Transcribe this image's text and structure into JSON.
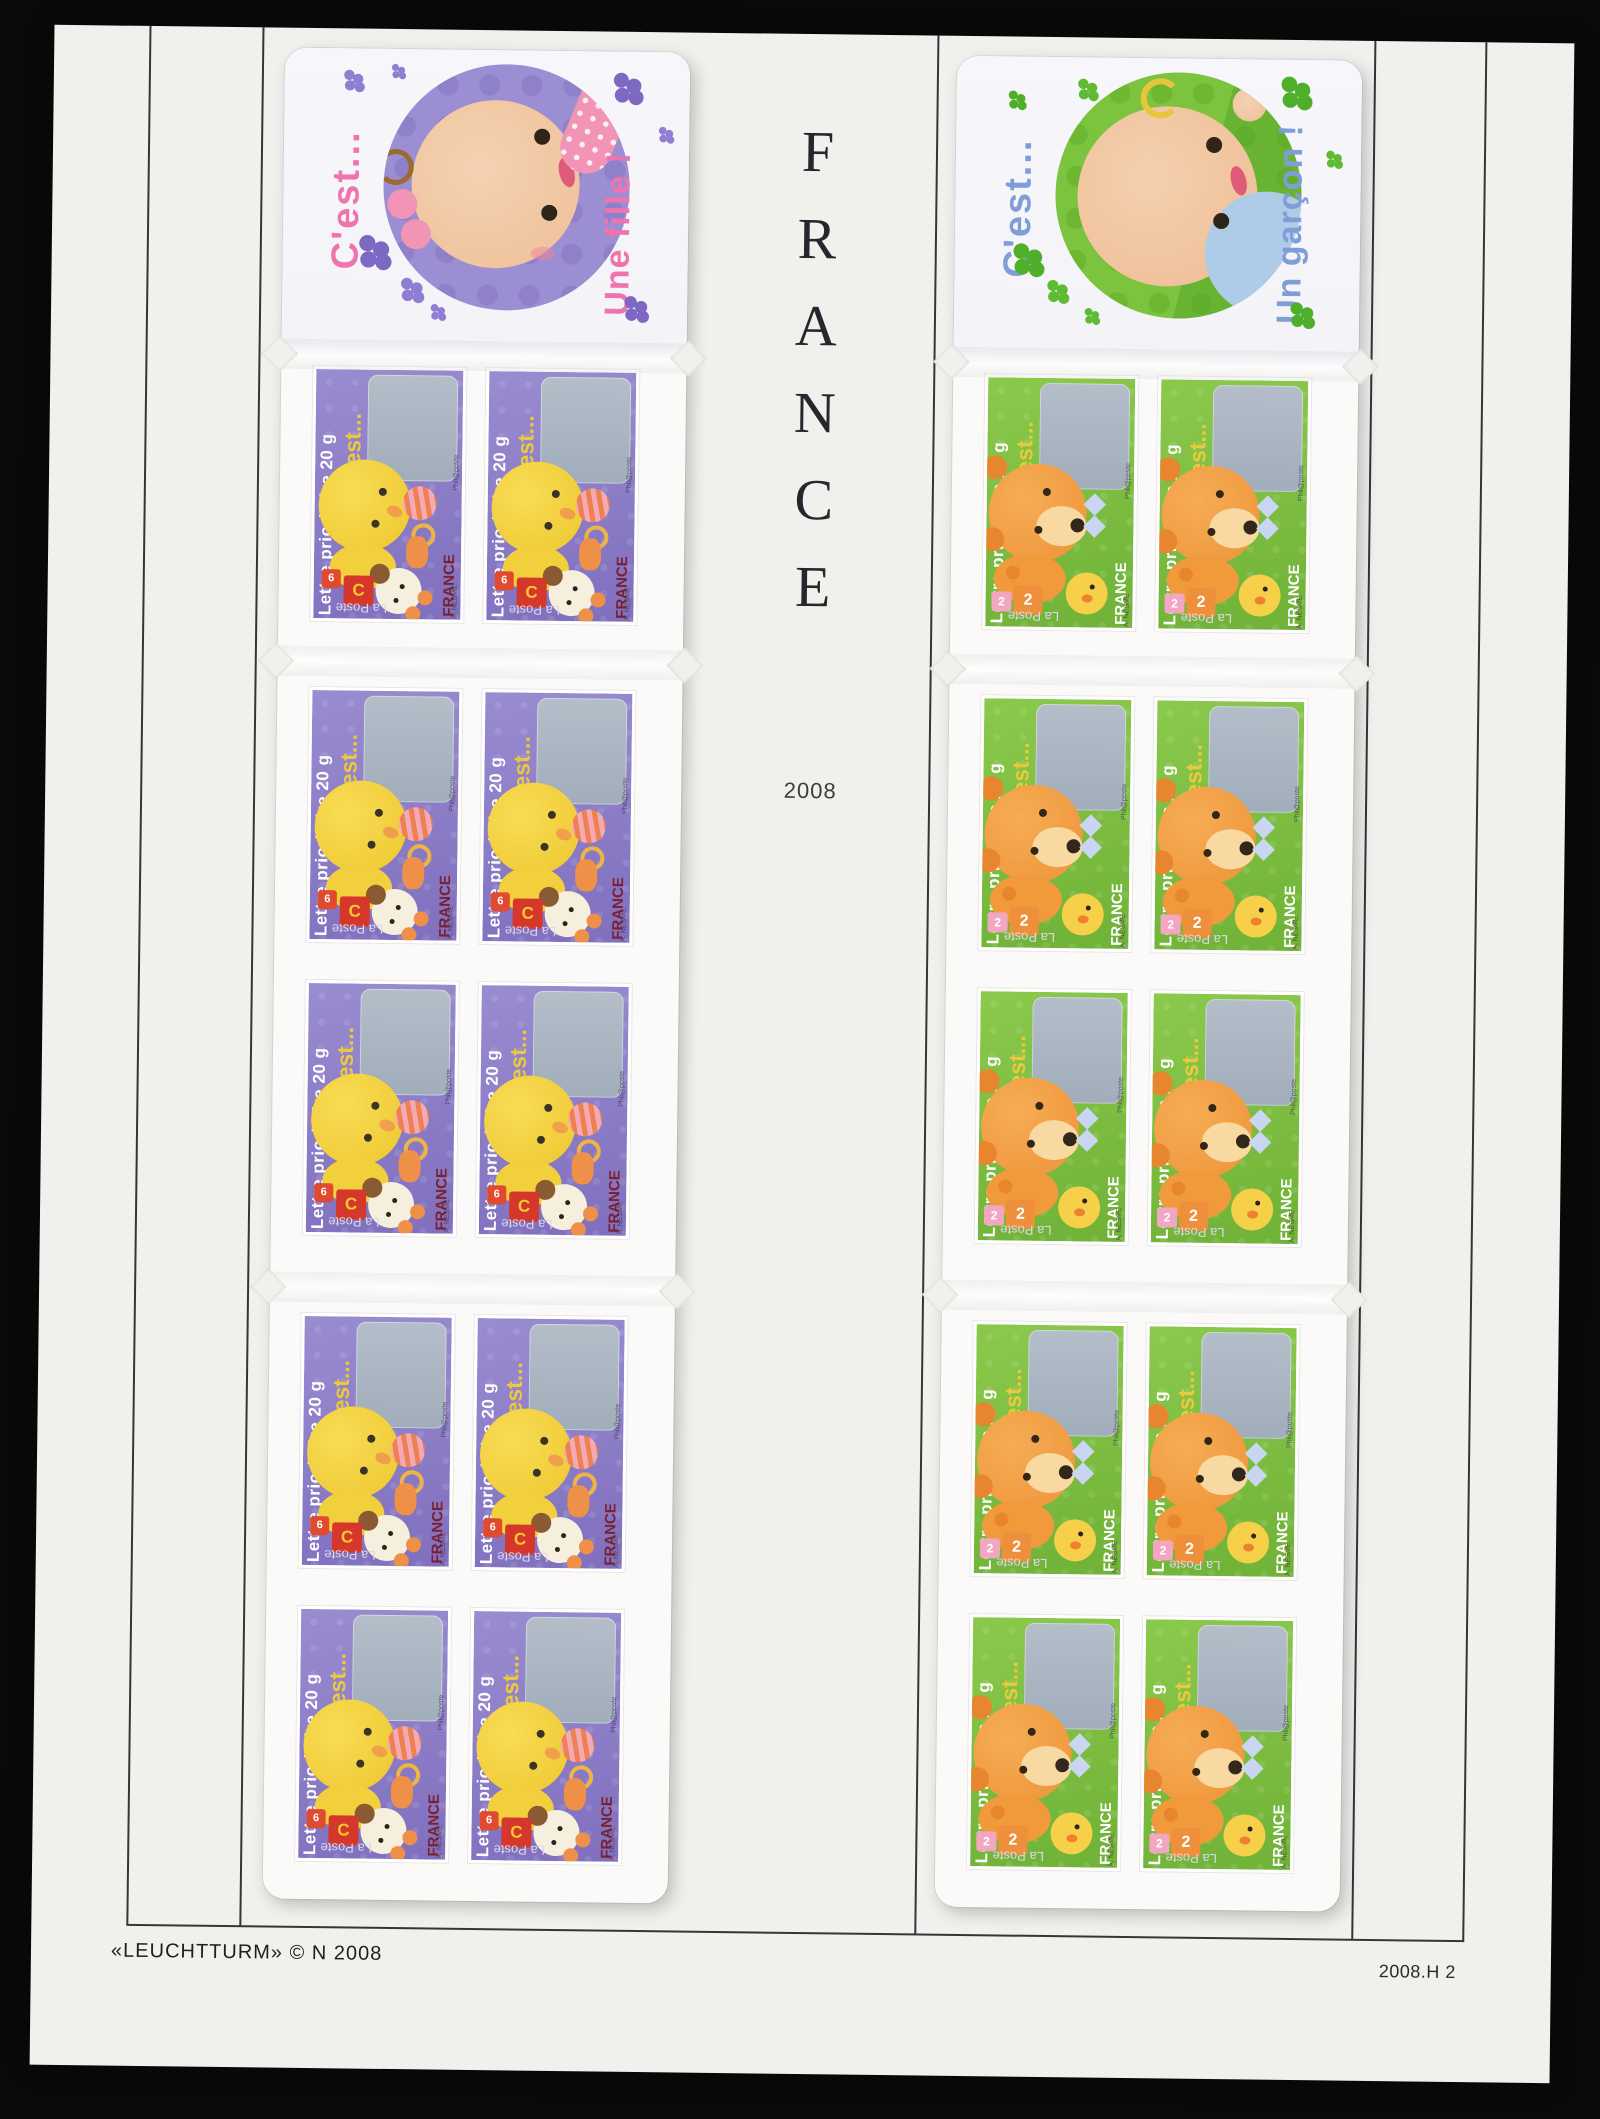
{
  "photo": {
    "background_color": "#0a0a0a"
  },
  "album_page": {
    "paper_color": "#f1f0ed",
    "frame_color": "#34343c",
    "country_letters": [
      "F",
      "R",
      "A",
      "N",
      "C",
      "E"
    ],
    "year": "2008",
    "footer_left": "«LEUCHTTURM» © N 2008",
    "footer_right": "2008.H 2"
  },
  "booklet_fille": {
    "name": "C'est... Une fille !",
    "cover": {
      "cest": "C'est...",
      "title": "Une fille !"
    },
    "accent_color": "#ef74ae",
    "circle_color": "#9c8ed2",
    "stamp": {
      "bg_color": "#8d7fc7",
      "cest": "C'est...",
      "block_letter": "C",
      "block_digit": "6",
      "france_color": "#7a2030"
    },
    "stamp_count": 10
  },
  "booklet_garcon": {
    "name": "C'est... Un garçon !",
    "cover": {
      "cest": "C'est...",
      "title": "Un garçon !"
    },
    "accent_color": "#7f9ed8",
    "circle_color": "#7cc33e",
    "stamp": {
      "bg_color": "#7fc043",
      "cest": "C'est...",
      "block_digit": "2"
    },
    "stamp_count": 10
  },
  "stamp_common": {
    "lettre": "Lettre prioritaire 20 g",
    "la_poste": "La Poste",
    "france": "FRANCE",
    "printer": "Phil@poste",
    "artist": "A. NESME"
  }
}
